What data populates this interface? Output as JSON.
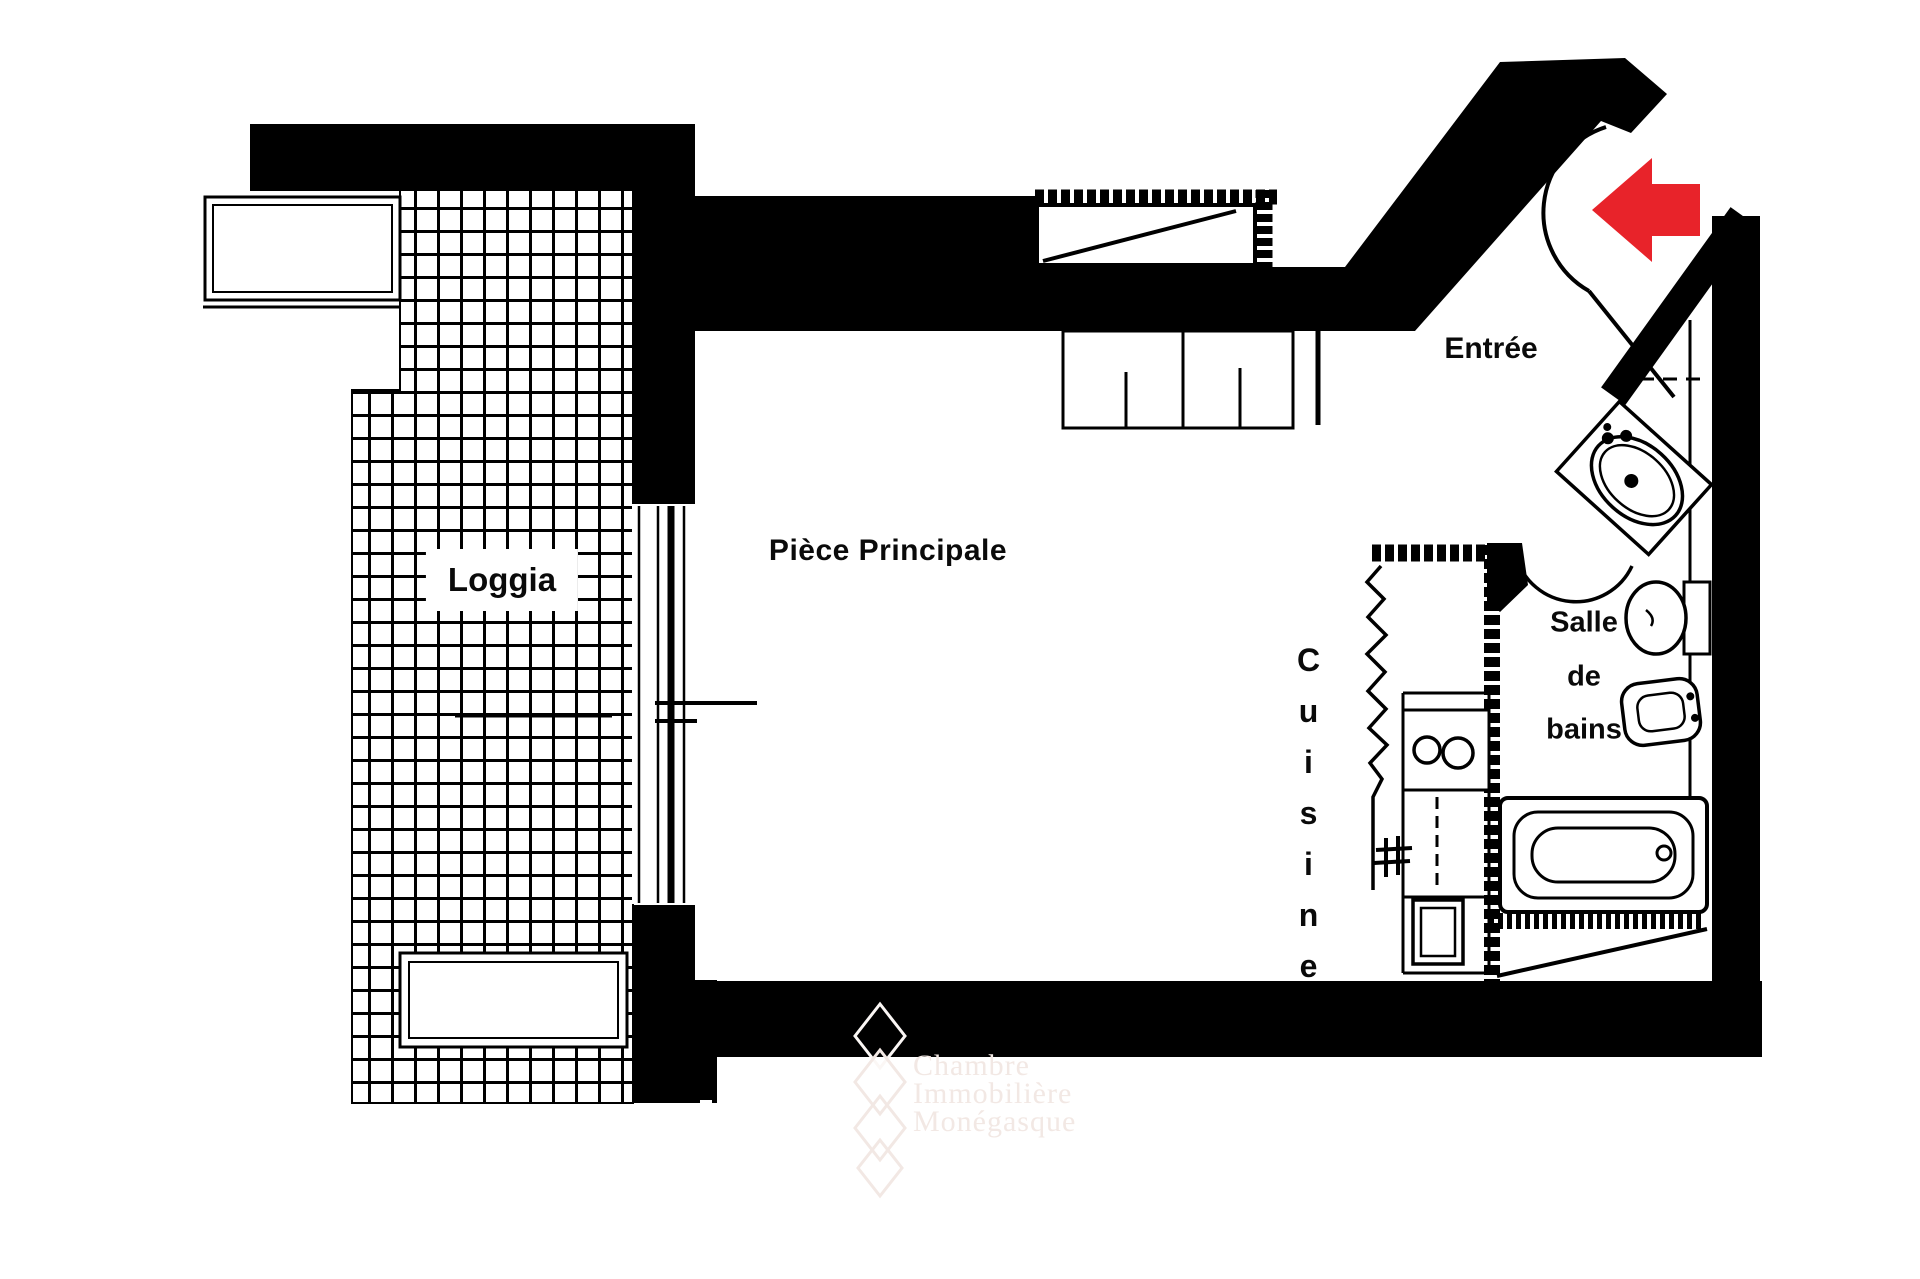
{
  "rooms": {
    "loggia": {
      "label": "Loggia"
    },
    "main_room": {
      "label": "Pièce Principale"
    },
    "entrance": {
      "label": "Entrée"
    },
    "kitchen": {
      "label": "Cuisine"
    },
    "bathroom": {
      "lines": [
        "Salle",
        "de",
        "bains"
      ]
    }
  },
  "annotations": {
    "watermark_lines": [
      "Chambre",
      "Immobilière",
      "Monégasque"
    ]
  },
  "colors": {
    "wall_black": "#000000",
    "entry_arrow_red": "#e8232a",
    "watermark_pink": "#f2e8e4",
    "floor_white": "#ffffff"
  },
  "icons": {
    "entry_arrow": "left-arrow",
    "fixtures": [
      "washbasin",
      "toilet",
      "bidet",
      "bathtub",
      "stove-burners",
      "kitchen-sink",
      "wardrobe-rail",
      "tiled-floor",
      "door-swing-arc",
      "window",
      "planter",
      "drain-hash"
    ]
  }
}
